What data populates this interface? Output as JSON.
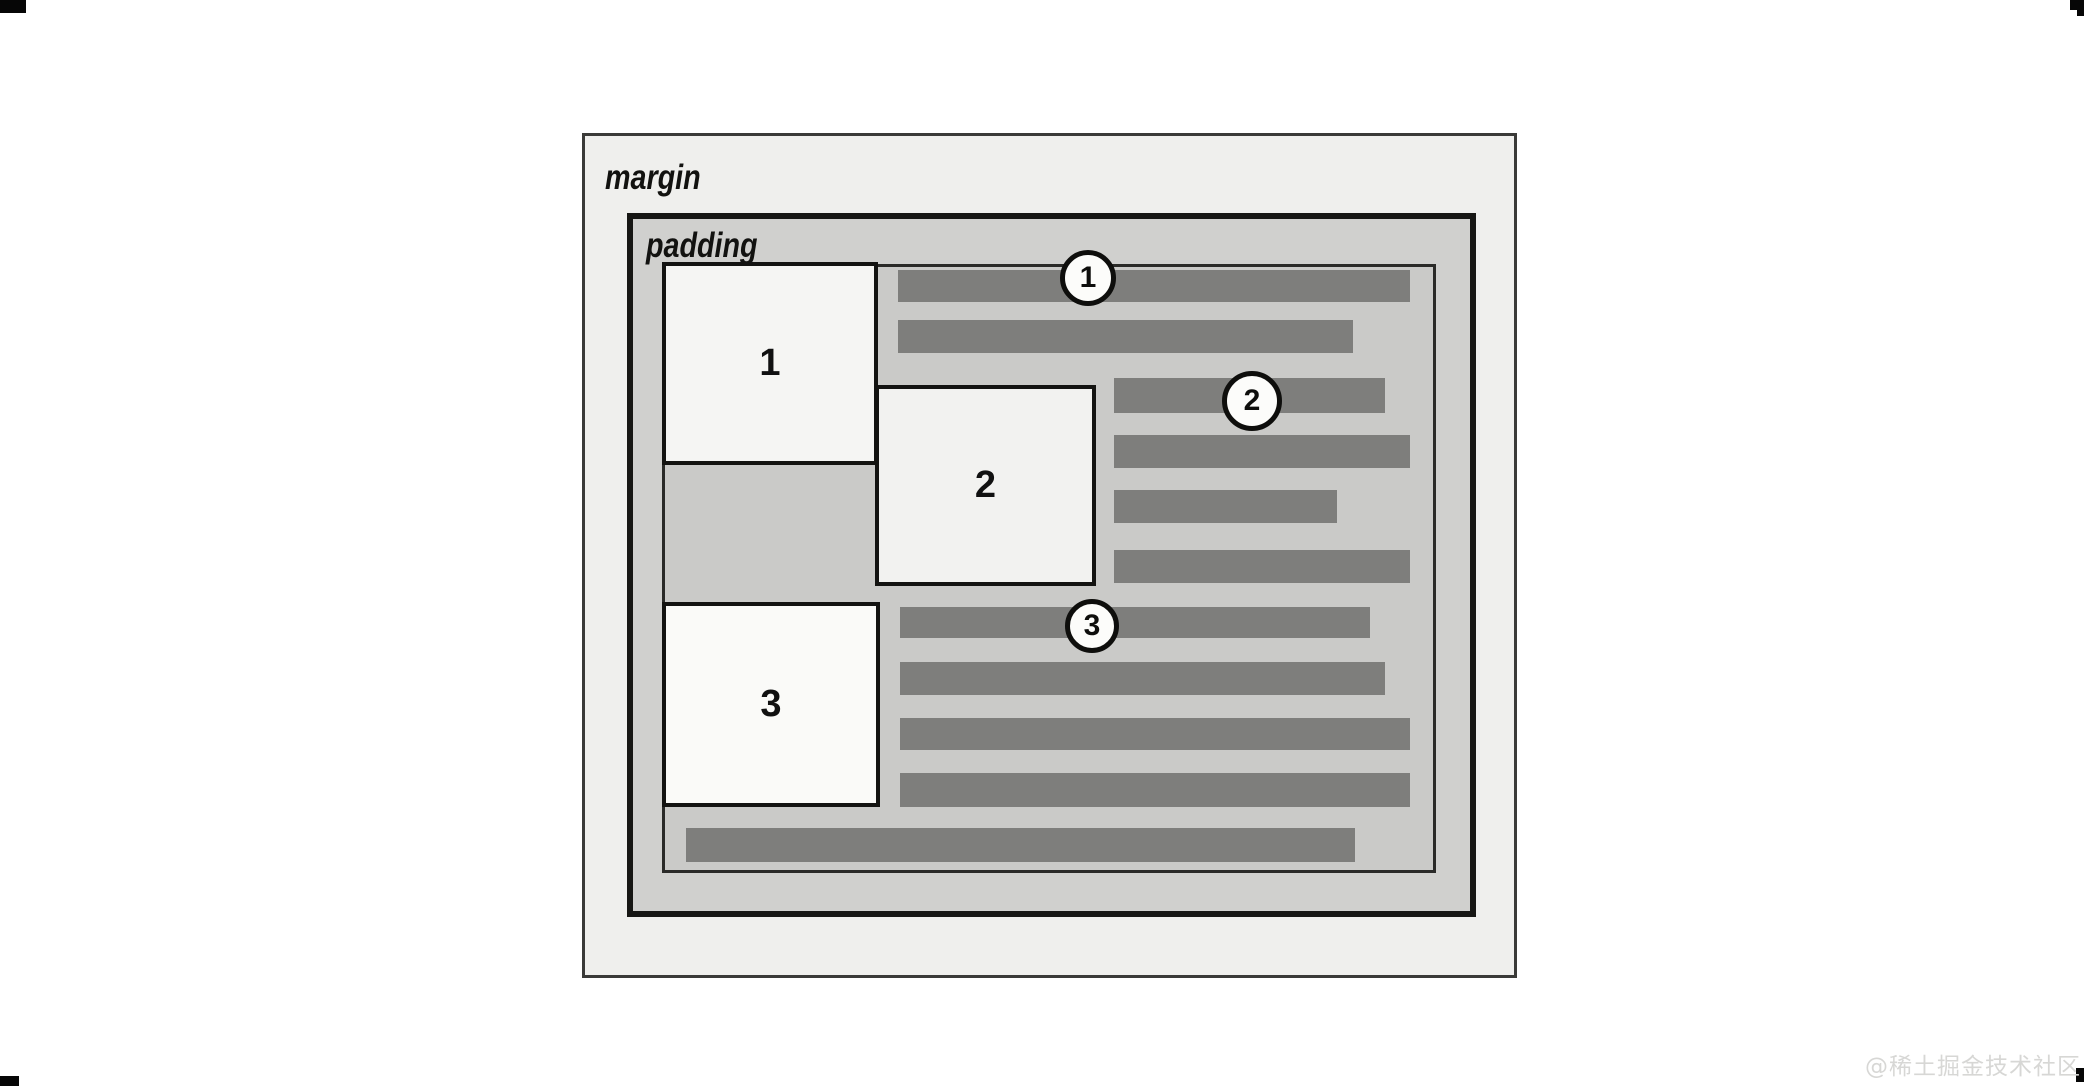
{
  "watermark": "@稀土掘金技术社区",
  "figure": {
    "margin_label": "margin",
    "padding_label": "padding",
    "float_boxes": [
      {
        "number": "1"
      },
      {
        "number": "2"
      },
      {
        "number": "3"
      }
    ],
    "callouts": [
      {
        "number": "1"
      },
      {
        "number": "2"
      },
      {
        "number": "3"
      }
    ],
    "colors": {
      "margin_area": "#EFEFED",
      "padding_area": "#D0D0CE",
      "content_area": "#CACAC8",
      "text_line": "#7E7E7C",
      "border": "#161614",
      "float_box_fill": "#F6F6F4",
      "callout_fill": "#FCFCFA"
    },
    "text_lines": {
      "description": "Gray bars depicting lines of text flowing around three floated boxes; 2 lines beside box 1, 4 beside box 2, 4 beside box 3, and 1 full-width closing line.",
      "bars": [
        {
          "x": 233,
          "y": 3,
          "w": 512,
          "h": 32
        },
        {
          "x": 233,
          "y": 53,
          "w": 455,
          "h": 33
        },
        {
          "x": 449,
          "y": 111,
          "w": 271,
          "h": 35
        },
        {
          "x": 449,
          "y": 168,
          "w": 296,
          "h": 33
        },
        {
          "x": 449,
          "y": 223,
          "w": 223,
          "h": 33
        },
        {
          "x": 449,
          "y": 283,
          "w": 296,
          "h": 33
        },
        {
          "x": 235,
          "y": 340,
          "w": 470,
          "h": 31
        },
        {
          "x": 235,
          "y": 395,
          "w": 485,
          "h": 33
        },
        {
          "x": 235,
          "y": 451,
          "w": 510,
          "h": 32
        },
        {
          "x": 235,
          "y": 506,
          "w": 510,
          "h": 34
        },
        {
          "x": 21,
          "y": 561,
          "w": 669,
          "h": 34
        }
      ]
    }
  }
}
